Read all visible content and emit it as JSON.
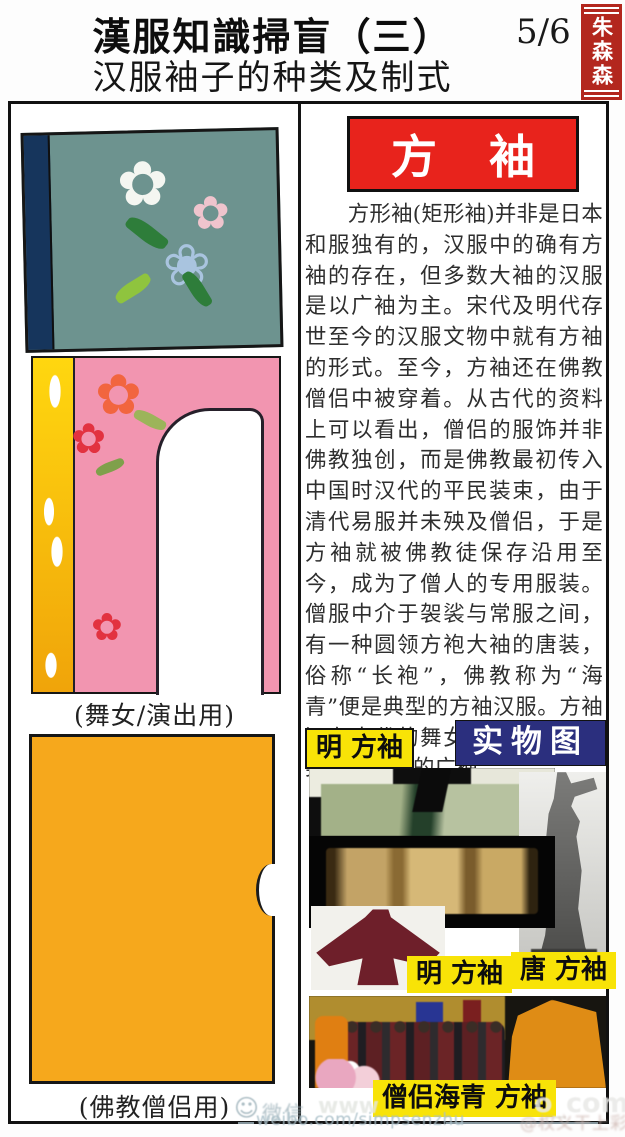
{
  "header": {
    "title": "漢服知識掃盲（三）",
    "page_number": "5/6",
    "seal": "朱森森",
    "subtitle": "汉服袖子的种类及制式"
  },
  "left_column": {
    "dancer_caption": "(舞女/演出用)",
    "monk_caption": "(佛教僧侣用)"
  },
  "right_column": {
    "banner_title": "方 袖",
    "paragraph": "方形袖(矩形袖)并非是日本和服独有的，汉服中的确有方袖的存在，但多数大袖的汉服是以广袖为主。宋代及明代存世至今的汉服文物中就有方袖的形式。至今，方袖还在佛教僧侣中被穿着。从古代的资料上可以看出，僧侣的服饰并非佛教独创，而是佛教最初传入中国时汉代的平民装束，由于清代易服并未殃及僧侣，于是方袖就被佛教徒保存沿用至今，成为了僧人的专用服装。僧服中介于袈裟与常服之间，有一种圆领方袍大袖的唐装，俗称“长袍”，佛教称为“海青”便是典型的方袖汉服。方袖还在古代的舞女陶俑中出现，类似舞者服的广袖。",
    "label_ming_top": "明 方袖",
    "label_real_photo": "实物图",
    "label_ming": "明 方袖",
    "label_tang": "唐 方袖",
    "label_monk_haiqing": "僧侣海青 方袖"
  },
  "watermarks": {
    "wechat": "微信",
    "weibo_url": "weibo.com/simpsenzhu",
    "handle": "@权义干上彩",
    "photo_fragment_left": "www",
    "photo_fragment_right": "o_com"
  },
  "icons": {
    "flower": "✿",
    "flower_outline": "❀",
    "smiley": "☺"
  },
  "colors": {
    "banner_red": "#e8231c",
    "seal_red": "#b3271e",
    "label_yellow": "#f8e307",
    "label_navy": "#2b2f7e",
    "sleeve_teal": "#6d938f",
    "sleeve_pink": "#f295b0",
    "sleeve_orange": "#f6a81c"
  }
}
